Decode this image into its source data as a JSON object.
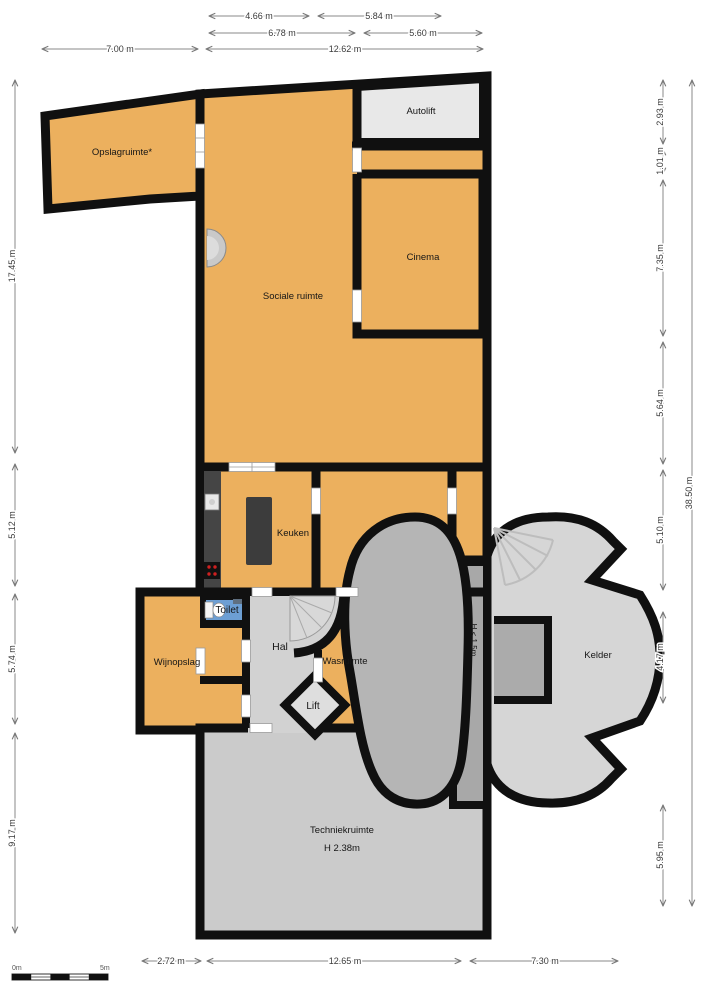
{
  "colors": {
    "room_fill": "#ECB05E",
    "wall": "#101010",
    "hall_floor": "#D2D2D2",
    "cellar_floor": "#D6D6D6",
    "tech_floor": "#CBCBCB",
    "rock_shape": "#B5B5B5",
    "low_height_strip": "#A8A8A8",
    "autolift_floor": "#E8E8E8",
    "toilet_fill": "#6D9FD4",
    "counter_dark": "#3E3E3E",
    "background": "#FFFFFF"
  },
  "rooms": {
    "opslagruimte": "Opslagruimte*",
    "sociale_ruimte": "Sociale ruimte",
    "autolift": "Autolift",
    "cinema": "Cinema",
    "keuken": "Keuken",
    "toilet": "Toilet",
    "hal": "Hal",
    "wasruimte": "Wasruimte",
    "lift": "Lift",
    "wijnopslag": "Wijnopslag",
    "kelder": "Kelder",
    "techniekruimte": "Techniekruimte",
    "techniekruimte_height": "H 2.38m",
    "low_clearance": "H < 1.5m"
  },
  "dimensions": {
    "top": [
      "4.66 m",
      "5.84 m",
      "6.78 m",
      "5.60 m",
      "7.00 m",
      "12.62 m"
    ],
    "left": [
      "17.45 m",
      "5.12 m",
      "5.74 m",
      "9.17 m"
    ],
    "right": [
      "2.93 m",
      "1.01 m",
      "7.35 m",
      "5.64 m",
      "5.10 m",
      "4.17 m",
      "5.95 m"
    ],
    "right_total": "38.50 m",
    "bottom": [
      "2.72 m",
      "12.65 m",
      "7.30 m"
    ]
  },
  "scale_bar": {
    "start": "0m",
    "end": "5m"
  }
}
